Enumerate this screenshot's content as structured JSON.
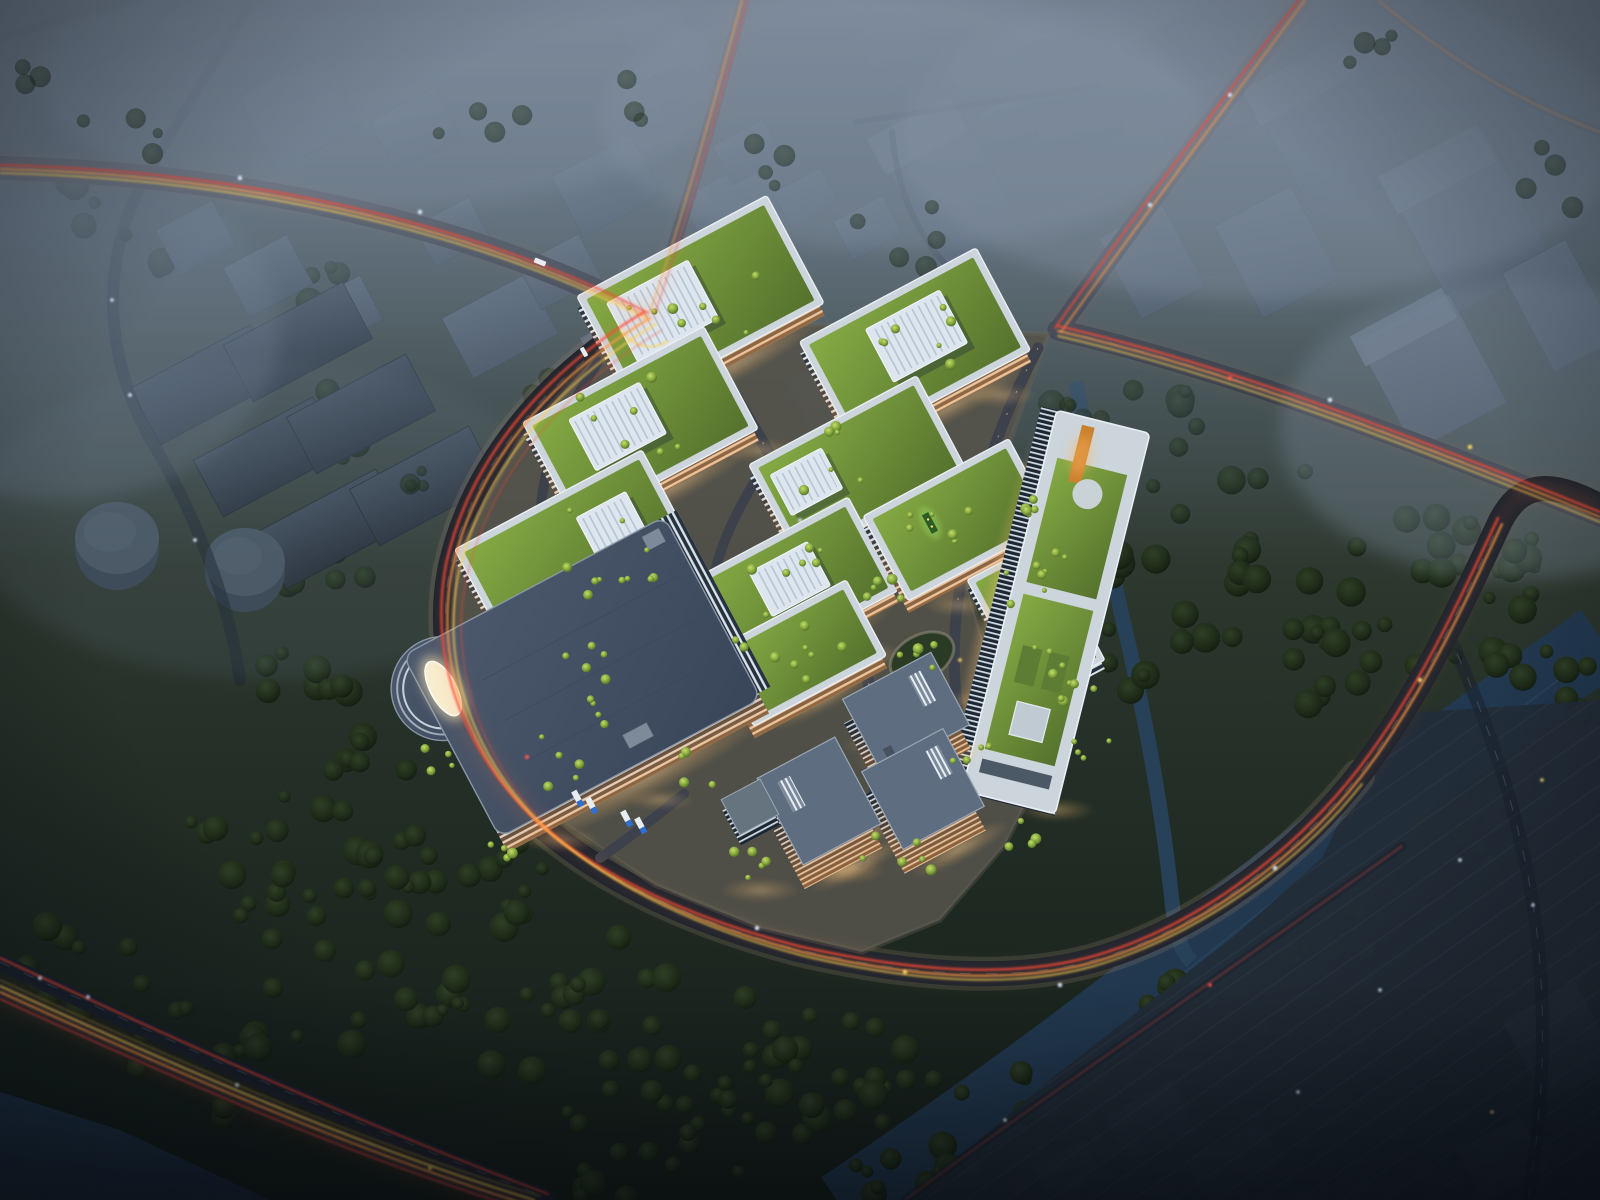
{
  "scene": {
    "description": "Dusk aerial rendering of an illuminated green-roof business park campus surrounded by foggy city blocks, arterial roads with car light trails, dark forests, a canal and a river",
    "time_of_day": "dusk",
    "view": "aerial oblique bird's-eye",
    "campus": {
      "office_blocks_with_green_roofs": 10,
      "rooftop_skylight_boxes": 6,
      "office_towers": 3,
      "logistics_warehouse_with_rounded_ramp": 1,
      "long_slab_building_with_roof_park": 1,
      "roof_park_features": [
        "lawns",
        "orange deck path",
        "helipad square",
        "hedge patterns",
        "trees"
      ]
    },
    "vehicles": {
      "dock_trucks": 4,
      "roadside_bus": 1,
      "cars": "sparse light dots"
    },
    "industrial_zone": {
      "dark_sheds": 6,
      "circular_storage_tanks": 2
    },
    "water": {
      "river_southeast": true,
      "campus_canal": true,
      "water_bottom_left": true
    },
    "roads": {
      "main_intersection": true,
      "curved_arterial_ring": true,
      "southwest_dual_highway": true,
      "light_trails": [
        "red",
        "orange",
        "yellow",
        "white headlights"
      ]
    },
    "atmosphere": {
      "fog_over_context_city": true,
      "vignette": true
    }
  },
  "palette": {
    "road": "#1a222e",
    "roadLit": "#3c414c",
    "sidewalk": "#8b8574",
    "plaza": "#55534b",
    "glow": "#ffcf8e",
    "trailRed": "#ff4836",
    "trailOrange": "#ff9a45",
    "trailYellow": "#ffd24f",
    "headlight": "#dcebff",
    "facade": "#d9e2ea",
    "glass": "#27323f",
    "roofDeck": "#ccd5db",
    "roofGreen1": "#7da23f",
    "roofGreen2": "#52702c",
    "skylight": "#dde6ee",
    "ctxWall": "#55616f",
    "ctxTop": "#6a7684",
    "shed": "#333e4b",
    "water": "#22394e",
    "waterHi": "#33516c",
    "truckBlue": "#2f6fd0",
    "truckWhite": "#e8edf2",
    "orangeDeck": "#c9812f",
    "warehouseRoof": "#45536a",
    "fog": "#8593a3"
  },
  "scatter": {
    "groups": [
      {
        "target": "trees-forest",
        "rmin": 6,
        "rmax": 15,
        "clusters": [
          [
            350,
            950,
            140,
            24
          ],
          [
            560,
            1015,
            120,
            20
          ],
          [
            700,
            1065,
            105,
            16
          ],
          [
            255,
            845,
            100,
            14
          ],
          [
            480,
            875,
            90,
            12
          ],
          [
            820,
            1075,
            85,
            12
          ],
          [
            880,
            1150,
            70,
            9
          ],
          [
            205,
            1060,
            85,
            11
          ],
          [
            95,
            965,
            75,
            9
          ],
          [
            620,
            1140,
            85,
            11
          ],
          [
            330,
            300,
            55,
            7
          ],
          [
            345,
            425,
            50,
            7
          ],
          [
            325,
            560,
            55,
            8
          ],
          [
            300,
            680,
            55,
            8
          ],
          [
            360,
            765,
            55,
            7
          ],
          [
            408,
            845,
            45,
            6
          ],
          [
            150,
            252,
            45,
            5
          ],
          [
            62,
            205,
            40,
            4
          ],
          [
            1185,
            520,
            105,
            14
          ],
          [
            1300,
            600,
            95,
            12
          ],
          [
            1420,
            562,
            85,
            10
          ],
          [
            1252,
            425,
            85,
            9
          ],
          [
            1495,
            625,
            75,
            9
          ],
          [
            1152,
            652,
            75,
            9
          ],
          [
            1352,
            700,
            85,
            10
          ],
          [
            1102,
            432,
            65,
            7
          ],
          [
            1052,
            1122,
            75,
            9
          ],
          [
            1198,
            1032,
            75,
            9
          ],
          [
            1332,
            932,
            65,
            8
          ],
          [
            1448,
            842,
            65,
            8
          ],
          [
            748,
            1122,
            75,
            9
          ],
          [
            918,
            1078,
            60,
            7
          ],
          [
            1500,
            540,
            60,
            7
          ],
          [
            1562,
            680,
            55,
            6
          ],
          [
            975,
            1180,
            55,
            6
          ]
        ]
      },
      {
        "target": "trees-faint",
        "rmin": 5,
        "rmax": 11,
        "clusters": [
          [
            905,
            232,
            55,
            5
          ],
          [
            482,
            122,
            48,
            4
          ],
          [
            762,
            152,
            48,
            4
          ],
          [
            648,
            95,
            40,
            3
          ],
          [
            1090,
            385,
            50,
            5
          ],
          [
            552,
            388,
            40,
            4
          ],
          [
            432,
            472,
            40,
            4
          ],
          [
            118,
            138,
            45,
            4
          ],
          [
            38,
            88,
            40,
            3
          ],
          [
            948,
            330,
            45,
            4
          ],
          [
            1545,
            180,
            50,
            4
          ],
          [
            1355,
            55,
            45,
            4
          ]
        ]
      },
      {
        "target": "trees-campus",
        "rmin": 2.5,
        "rmax": 5.5,
        "clusters": [
          [
            695,
            298,
            72,
            8
          ],
          [
            912,
            344,
            68,
            7
          ],
          [
            638,
            424,
            70,
            7
          ],
          [
            856,
            466,
            62,
            6
          ],
          [
            572,
            548,
            70,
            7
          ],
          [
            788,
            586,
            62,
            6
          ],
          [
            956,
            518,
            55,
            6
          ],
          [
            798,
            652,
            48,
            5
          ],
          [
            1020,
            584,
            32,
            4
          ],
          [
            1048,
            654,
            32,
            4
          ],
          [
            1032,
            502,
            22,
            5
          ],
          [
            1046,
            560,
            20,
            4
          ],
          [
            1076,
            690,
            22,
            5
          ],
          [
            1092,
            748,
            20,
            4
          ],
          [
            762,
            642,
            45,
            6
          ],
          [
            878,
            602,
            36,
            5
          ],
          [
            622,
            702,
            36,
            5
          ],
          [
            542,
            762,
            40,
            5
          ],
          [
            978,
            762,
            34,
            4
          ],
          [
            898,
            852,
            44,
            6
          ],
          [
            758,
            862,
            36,
            5
          ],
          [
            1012,
            832,
            28,
            4
          ],
          [
            920,
            657,
            24,
            5
          ],
          [
            502,
            842,
            34,
            4
          ],
          [
            434,
            762,
            28,
            4
          ],
          [
            704,
            766,
            30,
            4
          ],
          [
            652,
            572,
            30,
            4
          ],
          [
            586,
            658,
            28,
            4
          ]
        ]
      }
    ]
  }
}
